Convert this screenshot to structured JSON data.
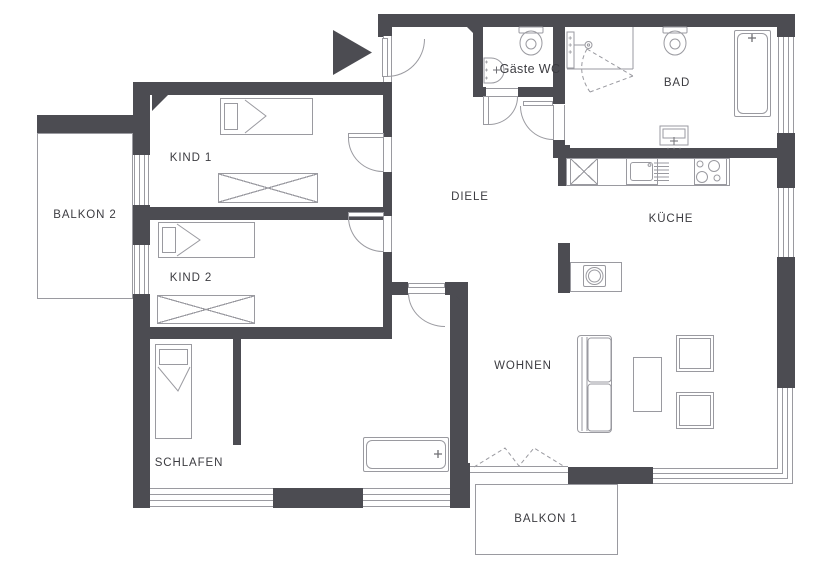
{
  "app": {
    "type": "apartment-floor-plan"
  },
  "colors": {
    "wall": "#4c4c52",
    "furniture_line": "#9a9aa0",
    "text": "#3c3c41",
    "background": "#ffffff"
  },
  "rooms": {
    "balkon2": {
      "label": "BALKON 2"
    },
    "kind1": {
      "label": "KIND 1"
    },
    "kind2": {
      "label": "KIND 2"
    },
    "schlafen": {
      "label": "SCHLAFEN"
    },
    "diele": {
      "label": "DIELE"
    },
    "gaeste_wc": {
      "label": "Gäste WC"
    },
    "bad": {
      "label": "BAD"
    },
    "kueche": {
      "label": "KÜCHE"
    },
    "wohnen": {
      "label": "WOHNEN"
    },
    "balkon1": {
      "label": "BALKON 1"
    }
  },
  "fixtures": [
    "entrance-arrow",
    "entrance-door",
    "single-bed-kind1",
    "wardrobe-kind1",
    "single-bed-kind2",
    "wardrobe-kind2",
    "single-bed-schlafen",
    "bathtub-schlafen",
    "toilet-gaeste-wc",
    "washbasin-gaeste-wc",
    "toilet-bad",
    "shower-bad",
    "bathtub-bad",
    "washbasin-bad",
    "kitchen-counter",
    "tall-cabinet",
    "kitchen-sink",
    "dishwasher",
    "stove",
    "washing-machine-island",
    "sofa",
    "coffee-table",
    "armchair",
    "folding-balcony-door",
    "corner-window"
  ]
}
